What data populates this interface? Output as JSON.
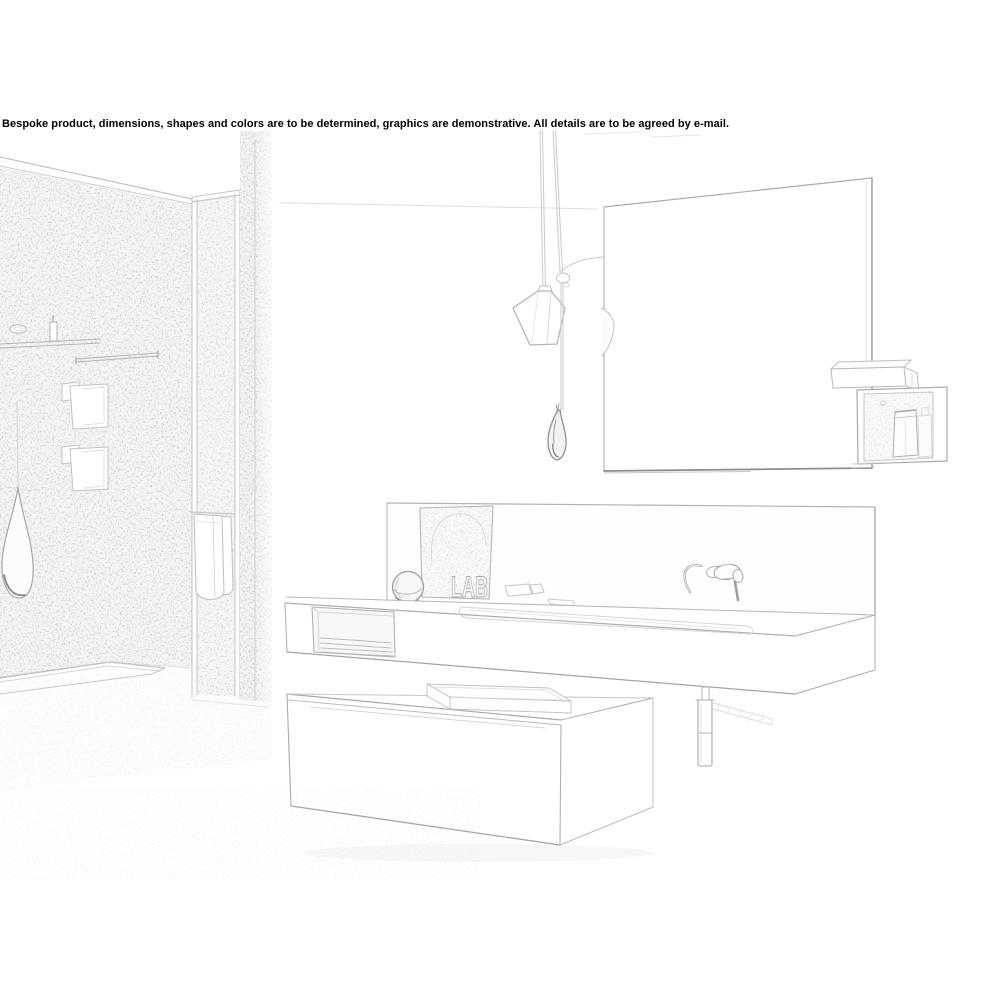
{
  "image": {
    "type": "pencil-sketch product rendering",
    "scene": "modern bathroom with walk-in shower, large mirror and wall-hung vanity"
  },
  "disclaimer": {
    "text": "Bespoke product, dimensions, shapes and colors are to be determined, graphics are demonstrative. All details are to be agreed by e-mail."
  },
  "artwork": {
    "book_label": "LAB"
  },
  "colors": {
    "background": "#ffffff",
    "sketch_line": "#b0b0b0",
    "sketch_line_dark": "#8d8d8d",
    "wall_tint": "#f4f4f4",
    "text": "#000000"
  },
  "objects": [
    "textured shower wall",
    "shower shelf with toiletries",
    "grab bar",
    "shower control plates",
    "teardrop pendant lamp",
    "glass partition with towel",
    "shower tray",
    "wall mirror",
    "faceted pendant lamp",
    "slender pendant vessel",
    "toiletry wall box with cosmetic tube",
    "vanity back panel",
    "leaning artwork board",
    "decorative sphere",
    "soap dishes",
    "wash counter with basin and open niche",
    "folded towels",
    "wall-mounted faucet",
    "drain pipe with towel bar",
    "floating drawer cabinet with tray"
  ]
}
